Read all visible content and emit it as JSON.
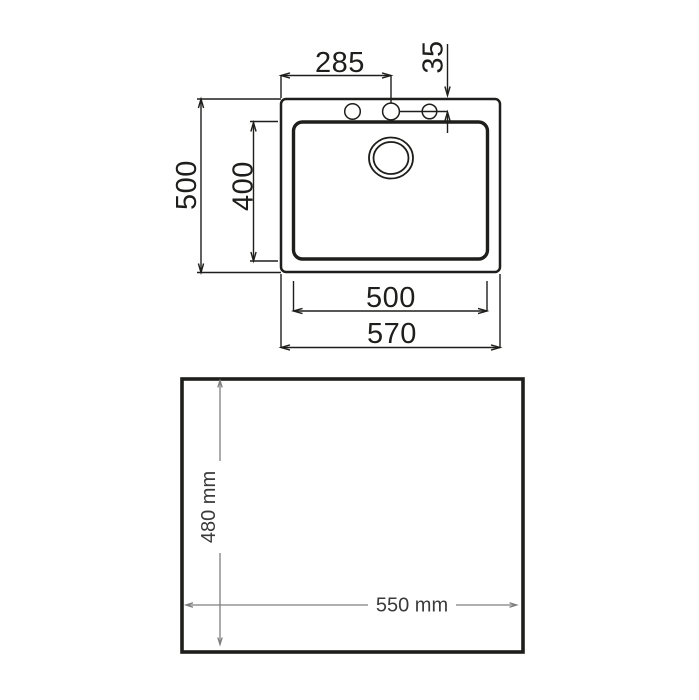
{
  "colors": {
    "ink": "#1e1e1c",
    "dim": "#7f7f7f",
    "label": "#3b3b3b"
  },
  "top_view": {
    "dims": {
      "faucet_span": "285",
      "hole_offset": "35",
      "overall_depth": "500",
      "bowl_depth": "400",
      "bowl_width": "500",
      "overall_width": "570"
    }
  },
  "cutout": {
    "dims": {
      "depth": "480 mm",
      "width": "550 mm"
    }
  }
}
